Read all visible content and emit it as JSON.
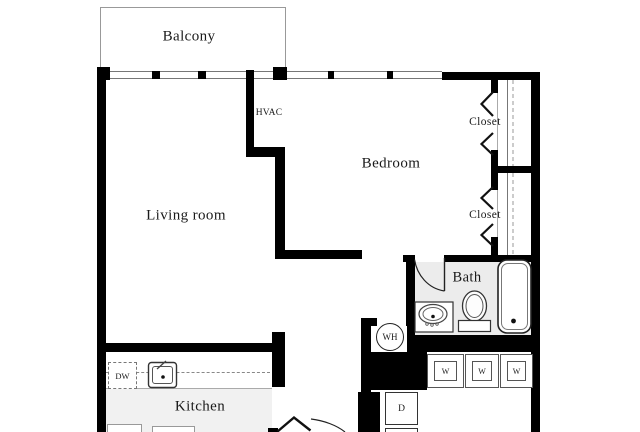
{
  "labels": {
    "balcony": "Balcony",
    "hvac": "HVAC",
    "bedroom": "Bedroom",
    "closet_top": "Closet",
    "closet_bottom": "Closet",
    "living_room": "Living room",
    "bath": "Bath",
    "kitchen": "Kitchen",
    "water_heater": "WH",
    "dishwasher": "DW",
    "dryer": "D",
    "washers": [
      "W",
      "W",
      "W"
    ]
  },
  "colors": {
    "wall": "#000000",
    "bath_floor": "#ececec",
    "kitchen_floor": "#f1f1f1",
    "outline_gray": "#999999",
    "text": "#1a1a1a"
  }
}
